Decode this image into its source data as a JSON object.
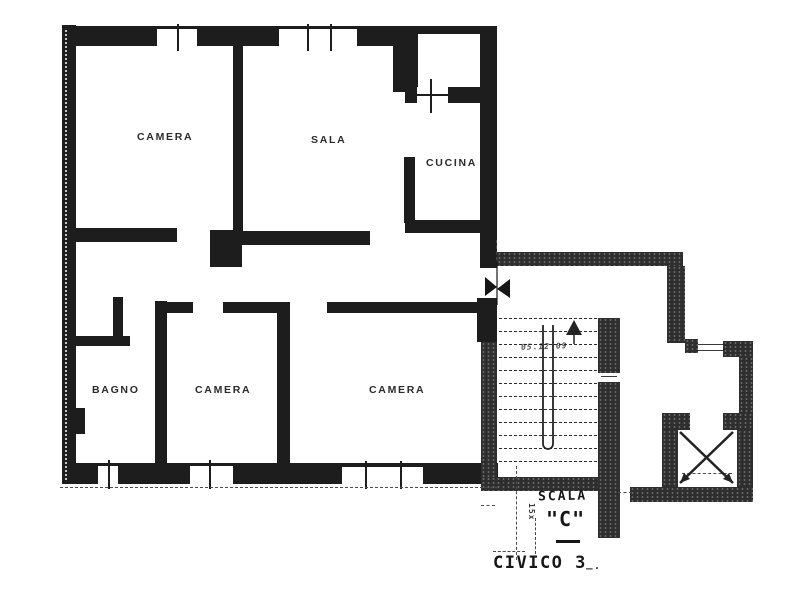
{
  "plan": {
    "kind": "apartment-floor-plan"
  },
  "rooms": [
    {
      "id": "camera-nw",
      "label": "CAMERA"
    },
    {
      "id": "sala",
      "label": "SALA"
    },
    {
      "id": "cucina",
      "label": "CUCINA"
    },
    {
      "id": "bagno",
      "label": "BAGNO"
    },
    {
      "id": "camera-s",
      "label": "CAMERA"
    },
    {
      "id": "camera-se",
      "label": "CAMERA"
    }
  ],
  "annotations": {
    "scala": "SCALA",
    "scala_letter": "\"C\"",
    "civico": "CIVICO 3",
    "riser_note": "15x",
    "step_note": "05.12 09",
    "trailing_dash": "‒·"
  },
  "colors": {
    "wall": "#1d1d1d",
    "stair_wall": "#2e2e2e",
    "ink": "#222222",
    "paper": "#ffffff"
  }
}
